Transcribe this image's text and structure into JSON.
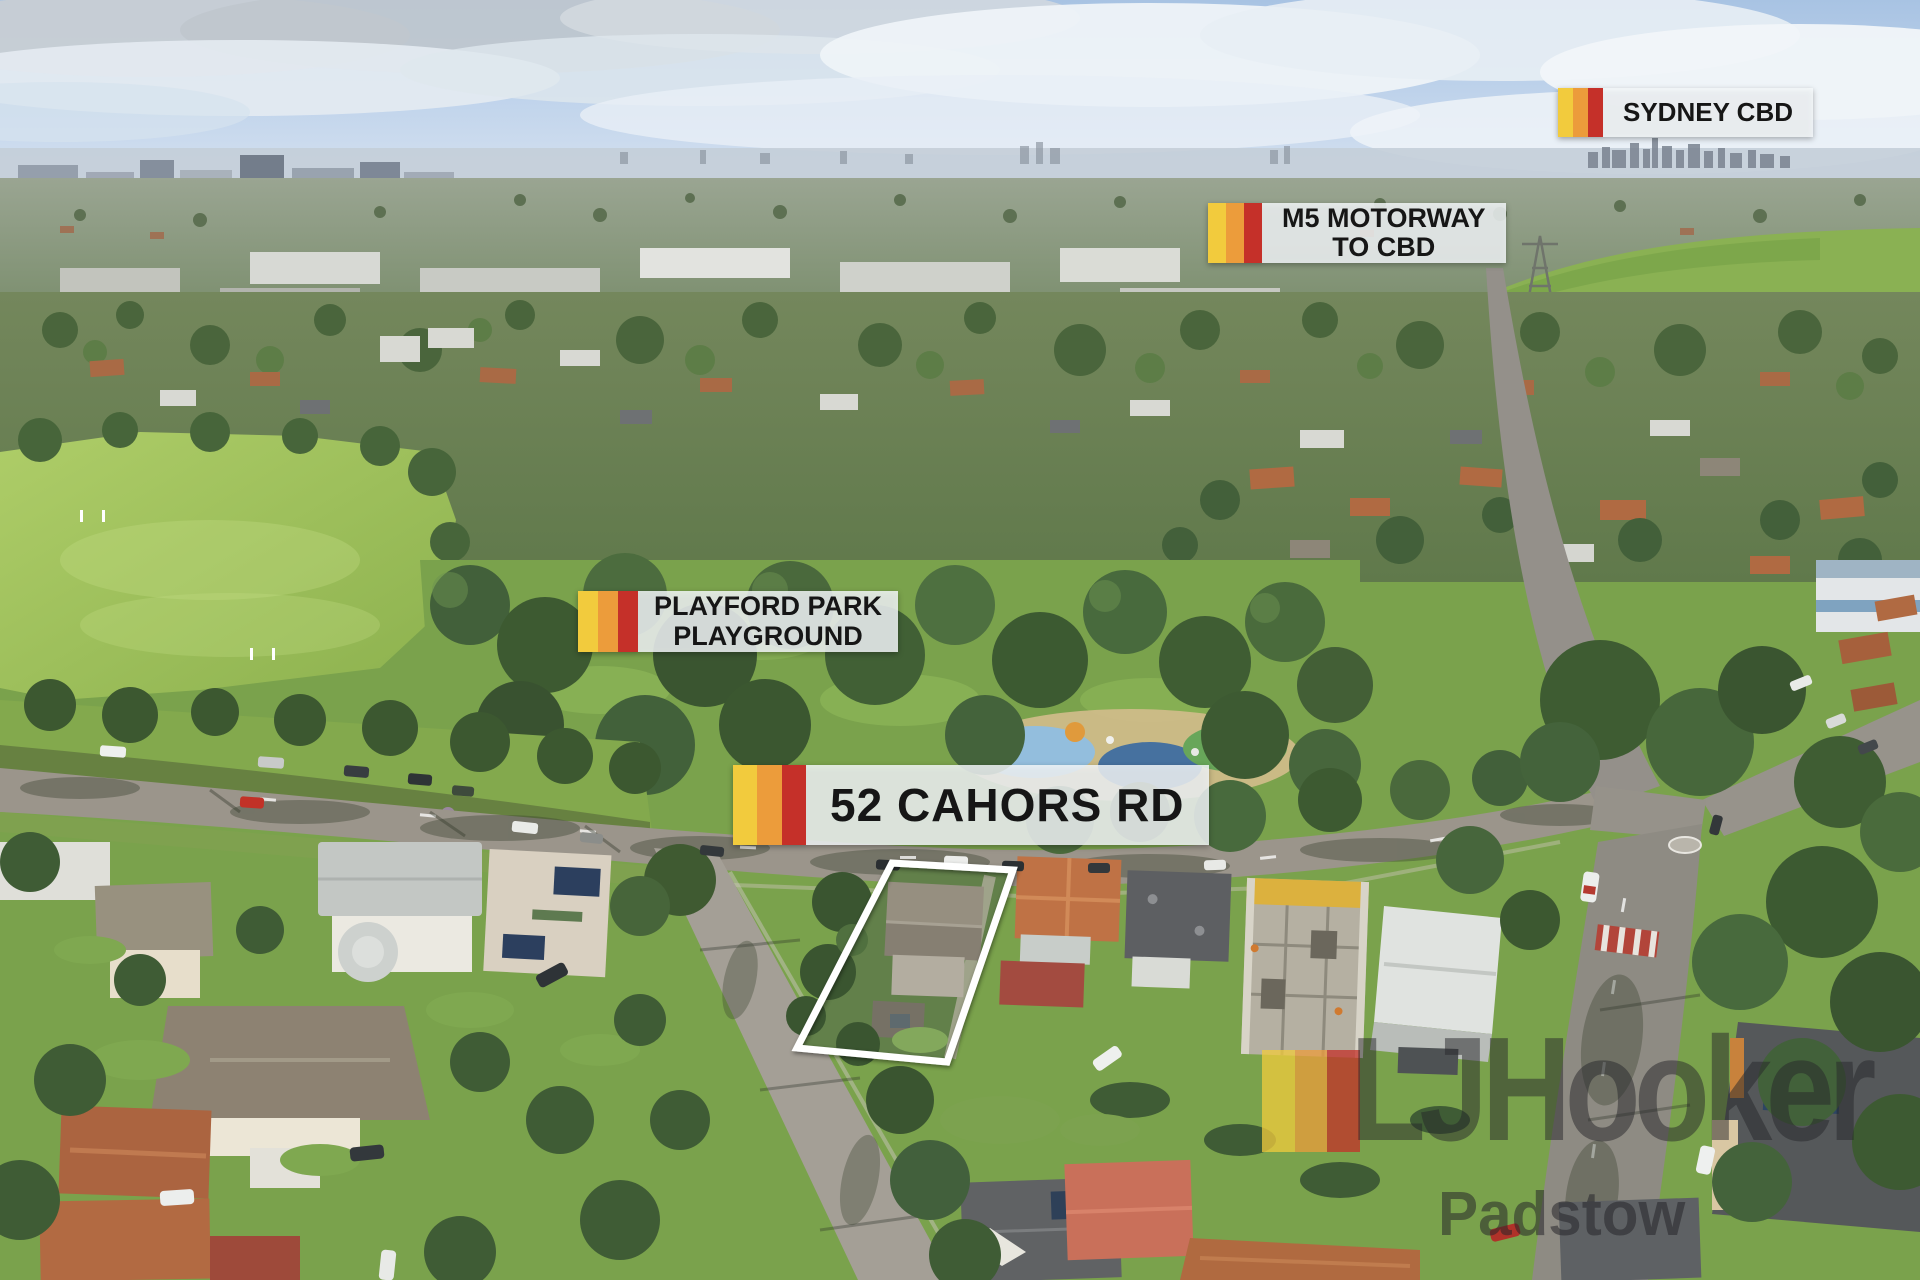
{
  "labels": {
    "sydney_cbd": {
      "text": "SYDNEY CBD"
    },
    "m5_motorway": {
      "line1": "M5 MOTORWAY",
      "line2": "TO CBD"
    },
    "playford_park": {
      "line1": "PLAYFORD PARK",
      "line2": "PLAYGROUND"
    },
    "property": {
      "text": "52 CAHORS RD"
    }
  },
  "watermark": {
    "brand": "LJHooker",
    "office": "Padstow"
  },
  "colors": {
    "flag_yellow": "#F2CB3D",
    "flag_orange": "#EC9C3B",
    "flag_red": "#C53029",
    "label_bg": "rgba(244,248,250,0.84)",
    "label_text": "#161616",
    "watermark_ink": "rgba(38,38,42,0.5)",
    "boundary_stroke": "#ffffff"
  }
}
